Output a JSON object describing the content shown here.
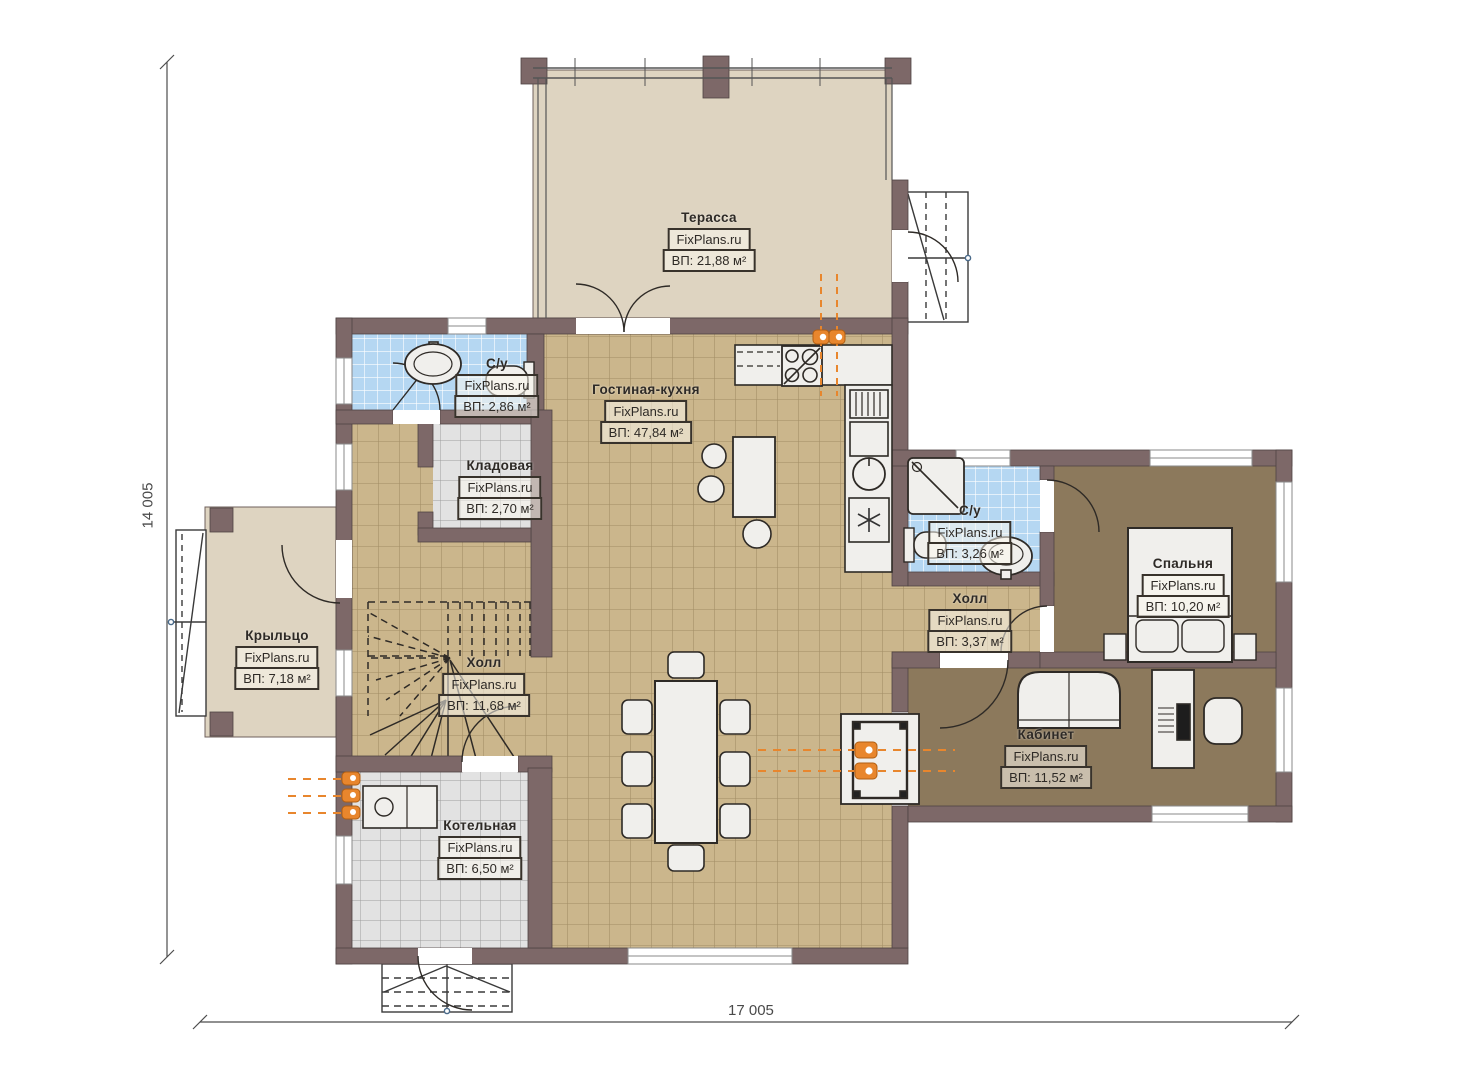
{
  "watermark": "FixPlans.ru",
  "dimensions": {
    "height_total": "14 005",
    "width_total": "17 005"
  },
  "rooms": [
    {
      "key": "terrace",
      "name": "Терасса",
      "area": "ВП: 21,88 м²"
    },
    {
      "key": "bathroom-1",
      "name": "С/у",
      "area": "ВП: 2,86 м²"
    },
    {
      "key": "storage",
      "name": "Кладовая",
      "area": "ВП: 2,70 м²"
    },
    {
      "key": "living-kitchen",
      "name": "Гостиная-кухня",
      "area": "ВП: 47,84 м²"
    },
    {
      "key": "porch",
      "name": "Крыльцо",
      "area": "ВП: 7,18 м²"
    },
    {
      "key": "hall-main",
      "name": "Холл",
      "area": "ВП: 11,68 м²"
    },
    {
      "key": "boiler-room",
      "name": "Котельная",
      "area": "ВП: 6,50 м²"
    },
    {
      "key": "bathroom-2",
      "name": "С/у",
      "area": "ВП: 3,26 м²"
    },
    {
      "key": "hall-wing",
      "name": "Холл",
      "area": "ВП: 3,37 м²"
    },
    {
      "key": "bedroom",
      "name": "Спальня",
      "area": "ВП: 10,20 м²"
    },
    {
      "key": "office",
      "name": "Кабинет",
      "area": "ВП: 11,52 м²"
    }
  ],
  "colors": {
    "wall": "#7d6868",
    "floor_tile_tan": "#cbb68c",
    "floor_tile_blue": "#b5d7f2",
    "floor_tile_gray": "#e2e2e2",
    "floor_dark": "#8c795c",
    "floor_terrace": "#ded4c1",
    "accent_orange": "#e8862d"
  }
}
